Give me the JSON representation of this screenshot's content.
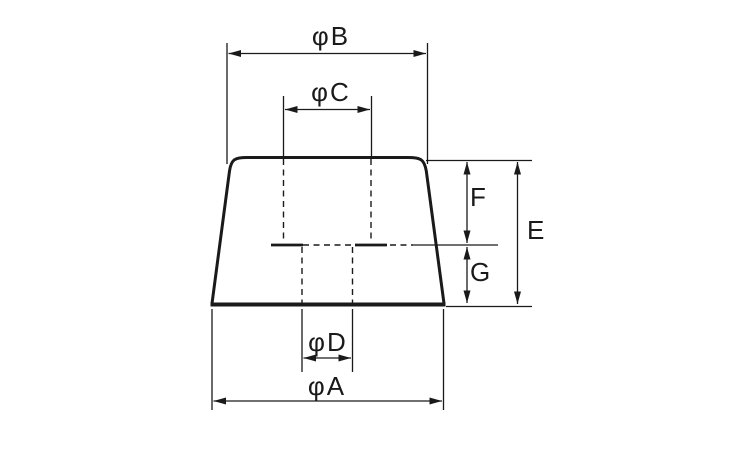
{
  "diagram": {
    "type": "technical-dimension-drawing",
    "labels": {
      "dia_b": "φB",
      "dia_c": "φC",
      "f": "F",
      "e": "E",
      "g": "G",
      "dia_d": "φD",
      "dia_a": "φA"
    },
    "colors": {
      "line": "#1a1a1a",
      "background": "#ffffff"
    }
  }
}
